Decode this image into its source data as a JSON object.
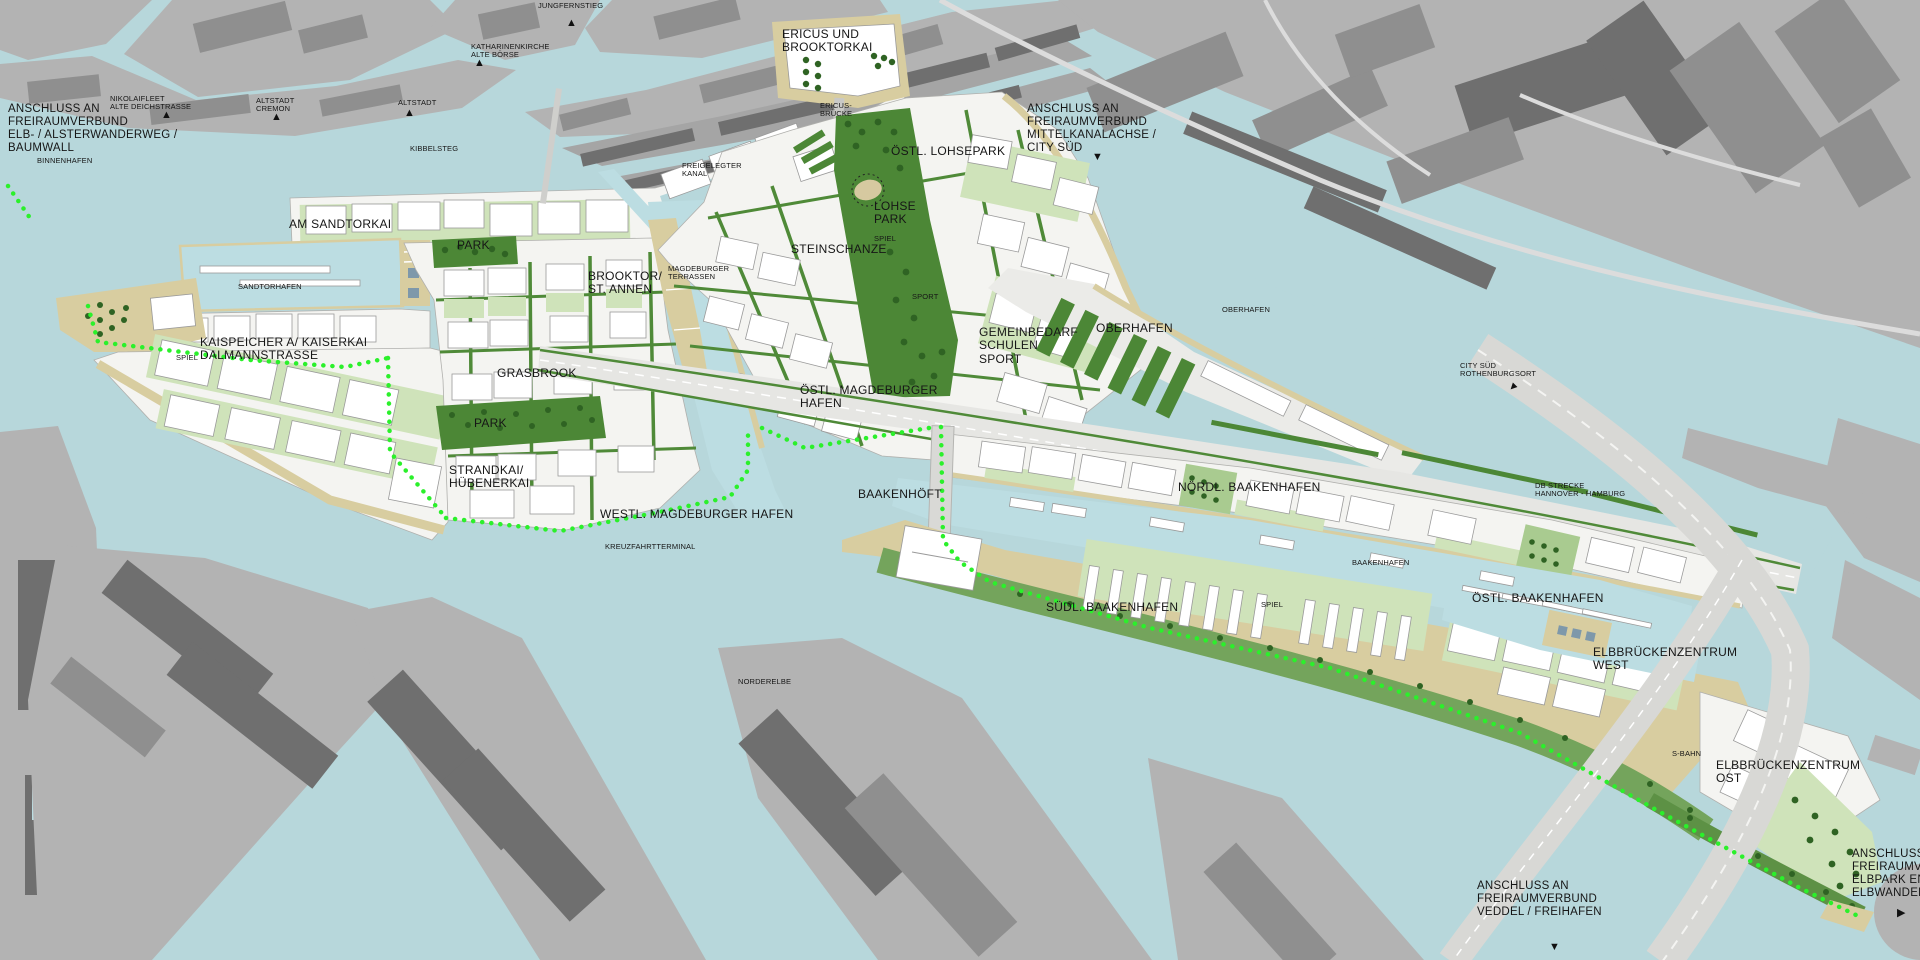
{
  "map_title": "HafenCity Hamburg Masterplan",
  "colors": {
    "water": "#b7d7db",
    "basin_water": "#bcdde2",
    "existing_city": "#b3b3b3",
    "building_mid": "#8f8f8f",
    "building_dark": "#6f6f6f",
    "new_ground": "#f4f4f1",
    "block_white": "#ffffff",
    "courtyard_green": "#cfe3ba",
    "street_green": "#4f8a38",
    "park_green": "#4c8736",
    "promenade_green": "#74a45c",
    "orchard_green": "#a9cb90",
    "quay_tan": "#d8cda0",
    "corridor_gray": "#e6e6e3",
    "trail_green": "#2bf02b",
    "label_color": "#161616"
  },
  "labels": [
    {
      "name": "conn-elb-alsterwanderweg",
      "kind": "conn",
      "x": 8,
      "y": 103,
      "lines": [
        "ANSCHLUSS AN",
        "FREIRAUMVERBUND",
        "ELB- / ALSTERWANDERWEG /",
        "BAUMWALL"
      ]
    },
    {
      "name": "conn-mittelkanalachse",
      "kind": "conn",
      "x": 1027,
      "y": 103,
      "lines": [
        "ANSCHLUSS AN",
        "FREIRAUMVERBUND",
        "MITTELKANALACHSE /",
        "CITY SÜD"
      ]
    },
    {
      "name": "conn-veddel-freihafen",
      "kind": "conn",
      "x": 1477,
      "y": 880,
      "lines": [
        "ANSCHLUSS AN",
        "FREIRAUMVERBUND",
        "VEDDEL / FREIHAFEN"
      ]
    },
    {
      "name": "conn-elbpark-entenwerder",
      "kind": "conn",
      "x": 1852,
      "y": 848,
      "lines": [
        "ANSCHLUSS AN",
        "FREIRAUMVERBU",
        "ELBPARK ENTEN",
        "ELBWANDERWEG"
      ]
    },
    {
      "name": "district-ericus-brooktorkai",
      "kind": "district",
      "x": 782,
      "y": 28,
      "lines": [
        "ERICUS UND",
        "BROOKTORKAI"
      ]
    },
    {
      "name": "district-am-sandtorkai",
      "kind": "district",
      "x": 289,
      "y": 218,
      "lines": [
        "AM SANDTORKAI"
      ]
    },
    {
      "name": "district-sandtorpark",
      "kind": "district",
      "x": 457,
      "y": 239,
      "lines": [
        "PARK"
      ]
    },
    {
      "name": "district-brooktor-st-annen",
      "kind": "district",
      "x": 588,
      "y": 270,
      "lines": [
        "BROOKTOR/",
        "ST. ANNEN"
      ]
    },
    {
      "name": "district-steinschanze",
      "kind": "district",
      "x": 791,
      "y": 243,
      "lines": [
        "STEINSCHANZE"
      ]
    },
    {
      "name": "district-oestl-lohsepark",
      "kind": "district",
      "x": 891,
      "y": 145,
      "lines": [
        "ÖSTL. LOHSEPARK"
      ]
    },
    {
      "name": "district-lohsepark",
      "kind": "district",
      "x": 874,
      "y": 200,
      "lines": [
        "LOHSE",
        "PARK"
      ]
    },
    {
      "name": "district-kaispeicher",
      "kind": "district",
      "x": 200,
      "y": 336,
      "lines": [
        "KAISPEICHER A/ KAISERKAI",
        "DALMANNSTRASSE"
      ]
    },
    {
      "name": "district-grasbrook",
      "kind": "district",
      "x": 497,
      "y": 367,
      "lines": [
        "GRASBROOK"
      ]
    },
    {
      "name": "district-grasbrook-park",
      "kind": "district",
      "x": 474,
      "y": 417,
      "lines": [
        "PARK"
      ]
    },
    {
      "name": "district-strandkai",
      "kind": "district",
      "x": 449,
      "y": 464,
      "lines": [
        "STRANDKAI/",
        "HÜBENERKAI"
      ]
    },
    {
      "name": "district-westl-magdeburger-hafen",
      "kind": "district",
      "x": 600,
      "y": 508,
      "lines": [
        "WESTL. MAGDEBURGER HAFEN"
      ]
    },
    {
      "name": "district-oestl-magdeburger-hafen",
      "kind": "district",
      "x": 800,
      "y": 384,
      "lines": [
        "ÖSTL. MAGDEBURGER",
        "HAFEN"
      ]
    },
    {
      "name": "district-gemeinbedarf",
      "kind": "district",
      "x": 979,
      "y": 326,
      "lines": [
        "GEMEINBEDARF",
        "SCHULEN",
        "SPORT"
      ]
    },
    {
      "name": "district-oberhafen",
      "kind": "district",
      "x": 1096,
      "y": 322,
      "lines": [
        "OBERHAFEN"
      ]
    },
    {
      "name": "district-baakenhoeft",
      "kind": "district",
      "x": 858,
      "y": 488,
      "lines": [
        "BAAKENHÖFT"
      ]
    },
    {
      "name": "district-noerdl-baakenhafen",
      "kind": "district",
      "x": 1178,
      "y": 481,
      "lines": [
        "NÖRDL. BAAKENHAFEN"
      ]
    },
    {
      "name": "district-suedl-baakenhafen",
      "kind": "district",
      "x": 1046,
      "y": 601,
      "lines": [
        "SÜDL. BAAKENHAFEN"
      ]
    },
    {
      "name": "district-oestl-baakenhafen",
      "kind": "district",
      "x": 1472,
      "y": 592,
      "lines": [
        "ÖSTL. BAAKENHAFEN"
      ]
    },
    {
      "name": "district-elbbrueckenzentrum-west",
      "kind": "district",
      "x": 1593,
      "y": 646,
      "lines": [
        "ELBBRÜCKENZENTRUM",
        "WEST"
      ]
    },
    {
      "name": "district-elbbrueckenzentrum-ost",
      "kind": "district",
      "x": 1716,
      "y": 759,
      "lines": [
        "ELBBRÜCKENZENTRUM",
        "OST"
      ]
    },
    {
      "name": "water-binnenhafen",
      "kind": "small",
      "x": 37,
      "y": 157,
      "lines": [
        "BINNENHAFEN"
      ]
    },
    {
      "name": "water-sandtorhafen",
      "kind": "small",
      "x": 238,
      "y": 283,
      "lines": [
        "SANDTORHAFEN"
      ]
    },
    {
      "name": "water-kreuzfahrtterminal",
      "kind": "small",
      "x": 605,
      "y": 543,
      "lines": [
        "KREUZFAHRTTERMINAL"
      ]
    },
    {
      "name": "water-norderelbe",
      "kind": "small",
      "x": 738,
      "y": 678,
      "lines": [
        "NORDERELBE"
      ]
    },
    {
      "name": "water-baakenhafen",
      "kind": "small",
      "x": 1352,
      "y": 559,
      "lines": [
        "BAAKENHAFEN"
      ]
    },
    {
      "name": "water-oberhafen",
      "kind": "small",
      "x": 1222,
      "y": 306,
      "lines": [
        "OBERHAFEN"
      ]
    },
    {
      "name": "ctx-nikolaifleet",
      "kind": "small",
      "x": 110,
      "y": 95,
      "lines": [
        "NIKOLAIFLEET",
        "ALTE DEICHSTRASSE"
      ]
    },
    {
      "name": "ctx-altstadt-cremon",
      "kind": "small",
      "x": 256,
      "y": 97,
      "lines": [
        "ALTSTADT",
        "CREMON"
      ]
    },
    {
      "name": "ctx-altstadt",
      "kind": "small",
      "x": 398,
      "y": 99,
      "lines": [
        "ALTSTADT"
      ]
    },
    {
      "name": "ctx-kibbelsteg",
      "kind": "small",
      "x": 410,
      "y": 145,
      "lines": [
        "KIBBELSTEG"
      ]
    },
    {
      "name": "ctx-jungfernstieg",
      "kind": "small",
      "x": 538,
      "y": 2,
      "lines": [
        "JUNGFERNSTIEG"
      ]
    },
    {
      "name": "ctx-katharinenkirche",
      "kind": "small",
      "x": 471,
      "y": 43,
      "lines": [
        "KATHARINENKIRCHE",
        "ALTE BÖRSE"
      ]
    },
    {
      "name": "ctx-ericus-bruecke",
      "kind": "small",
      "x": 820,
      "y": 102,
      "lines": [
        "ERICUS-",
        "BRÜCKE"
      ]
    },
    {
      "name": "ctx-freigelegter-kanal",
      "kind": "small",
      "x": 682,
      "y": 162,
      "lines": [
        "FREIGELEGTER",
        "KANAL"
      ]
    },
    {
      "name": "ctx-magdeburger-terrassen",
      "kind": "small",
      "x": 668,
      "y": 265,
      "lines": [
        "MAGDEBURGER",
        "TERRASSEN"
      ]
    },
    {
      "name": "ctx-spiel-lohsepark",
      "kind": "small",
      "x": 874,
      "y": 235,
      "lines": [
        "SPIEL"
      ]
    },
    {
      "name": "ctx-sport-lohsepark",
      "kind": "small",
      "x": 912,
      "y": 293,
      "lines": [
        "SPORT"
      ]
    },
    {
      "name": "ctx-spiel-kaispeicher",
      "kind": "small",
      "x": 176,
      "y": 354,
      "lines": [
        "SPIEL"
      ]
    },
    {
      "name": "ctx-spiel-baakenhafen",
      "kind": "small",
      "x": 1261,
      "y": 601,
      "lines": [
        "SPIEL"
      ]
    },
    {
      "name": "ctx-city-sued",
      "kind": "small",
      "x": 1460,
      "y": 362,
      "lines": [
        "CITY SÜD",
        "ROTHENBURGSORT"
      ]
    },
    {
      "name": "ctx-db-strecke",
      "kind": "small",
      "x": 1535,
      "y": 482,
      "lines": [
        "DB STRECKE",
        "HANNOVER - HAMBURG"
      ]
    },
    {
      "name": "ctx-s-bahn",
      "kind": "small",
      "x": 1672,
      "y": 750,
      "lines": [
        "S-BAHN"
      ]
    }
  ],
  "arrows": [
    {
      "name": "arrow-nikolaifleet",
      "x": 161,
      "y": 110,
      "dir": "up"
    },
    {
      "name": "arrow-cremon",
      "x": 271,
      "y": 112,
      "dir": "up"
    },
    {
      "name": "arrow-altstadt",
      "x": 404,
      "y": 108,
      "dir": "up"
    },
    {
      "name": "arrow-jungfernstieg",
      "x": 566,
      "y": 18,
      "dir": "up"
    },
    {
      "name": "arrow-katharinenkirche",
      "x": 474,
      "y": 58,
      "dir": "up"
    },
    {
      "name": "arrow-mittelkanalachse",
      "x": 1092,
      "y": 152,
      "dir": "down"
    },
    {
      "name": "arrow-city-sued",
      "x": 1507,
      "y": 382,
      "dir": "se"
    },
    {
      "name": "arrow-veddel",
      "x": 1549,
      "y": 942,
      "dir": "down"
    },
    {
      "name": "arrow-elbpark",
      "x": 1897,
      "y": 908,
      "dir": "right"
    }
  ]
}
